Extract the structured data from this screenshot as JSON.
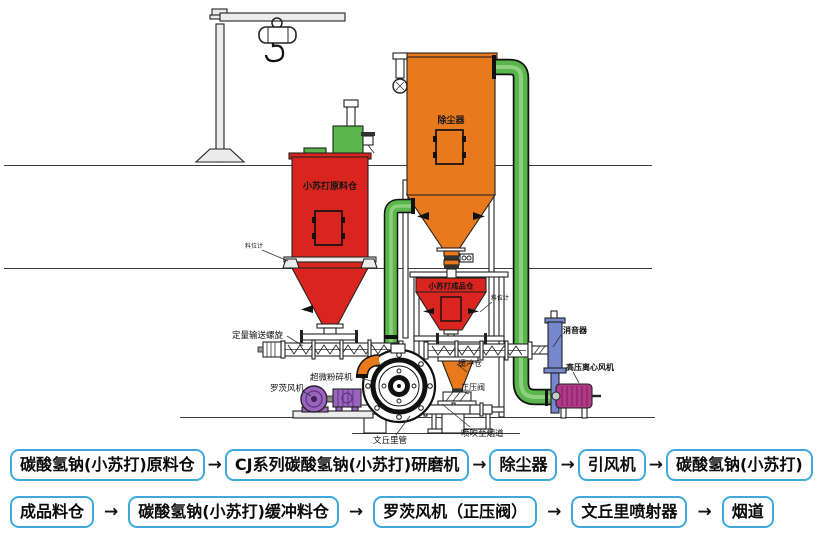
{
  "diagram": {
    "labels": {
      "raw_silo": "小苏打原料仓",
      "dust_collector": "除尘器",
      "product_bin": "小苏打成品仓",
      "dosing_screw": "定量输送螺旋",
      "mill": "超微粉碎机",
      "roots_blower": "罗茨风机",
      "venturi_tube": "文丘里管",
      "blow_to_flue": "喷吹至烟道",
      "buffer_bin": "缓冲仓",
      "positive_pressure_valve": "正压阀",
      "silencer": "消音器",
      "hp_centrifugal_fan": "高压离心风机",
      "level_gauge_left": "料位计",
      "level_gauge_right": "料位计"
    },
    "colors": {
      "vessel_red": "#d9251e",
      "collector_orange": "#e8791d",
      "pipe_green": "#5ab64a",
      "pipe_green_light": "#8fd07e",
      "blower_purple": "#9a63bd",
      "silencer_blue": "#7787cd",
      "fan_magenta": "#ae3a88",
      "flow_box_border": "#3fa9dc"
    }
  },
  "flowchart": {
    "arrow": "→",
    "row1": [
      "碳酸氢钠(小苏打)原料仓",
      "CJ系列碳酸氢钠(小苏打)研磨机",
      "除尘器",
      "引风机",
      "碳酸氢钠(小苏打)"
    ],
    "row2": [
      "成品料仓",
      "碳酸氢钠(小苏打)缓冲料仓",
      "罗茨风机（正压阀）",
      "文丘里喷射器",
      "烟道"
    ]
  }
}
